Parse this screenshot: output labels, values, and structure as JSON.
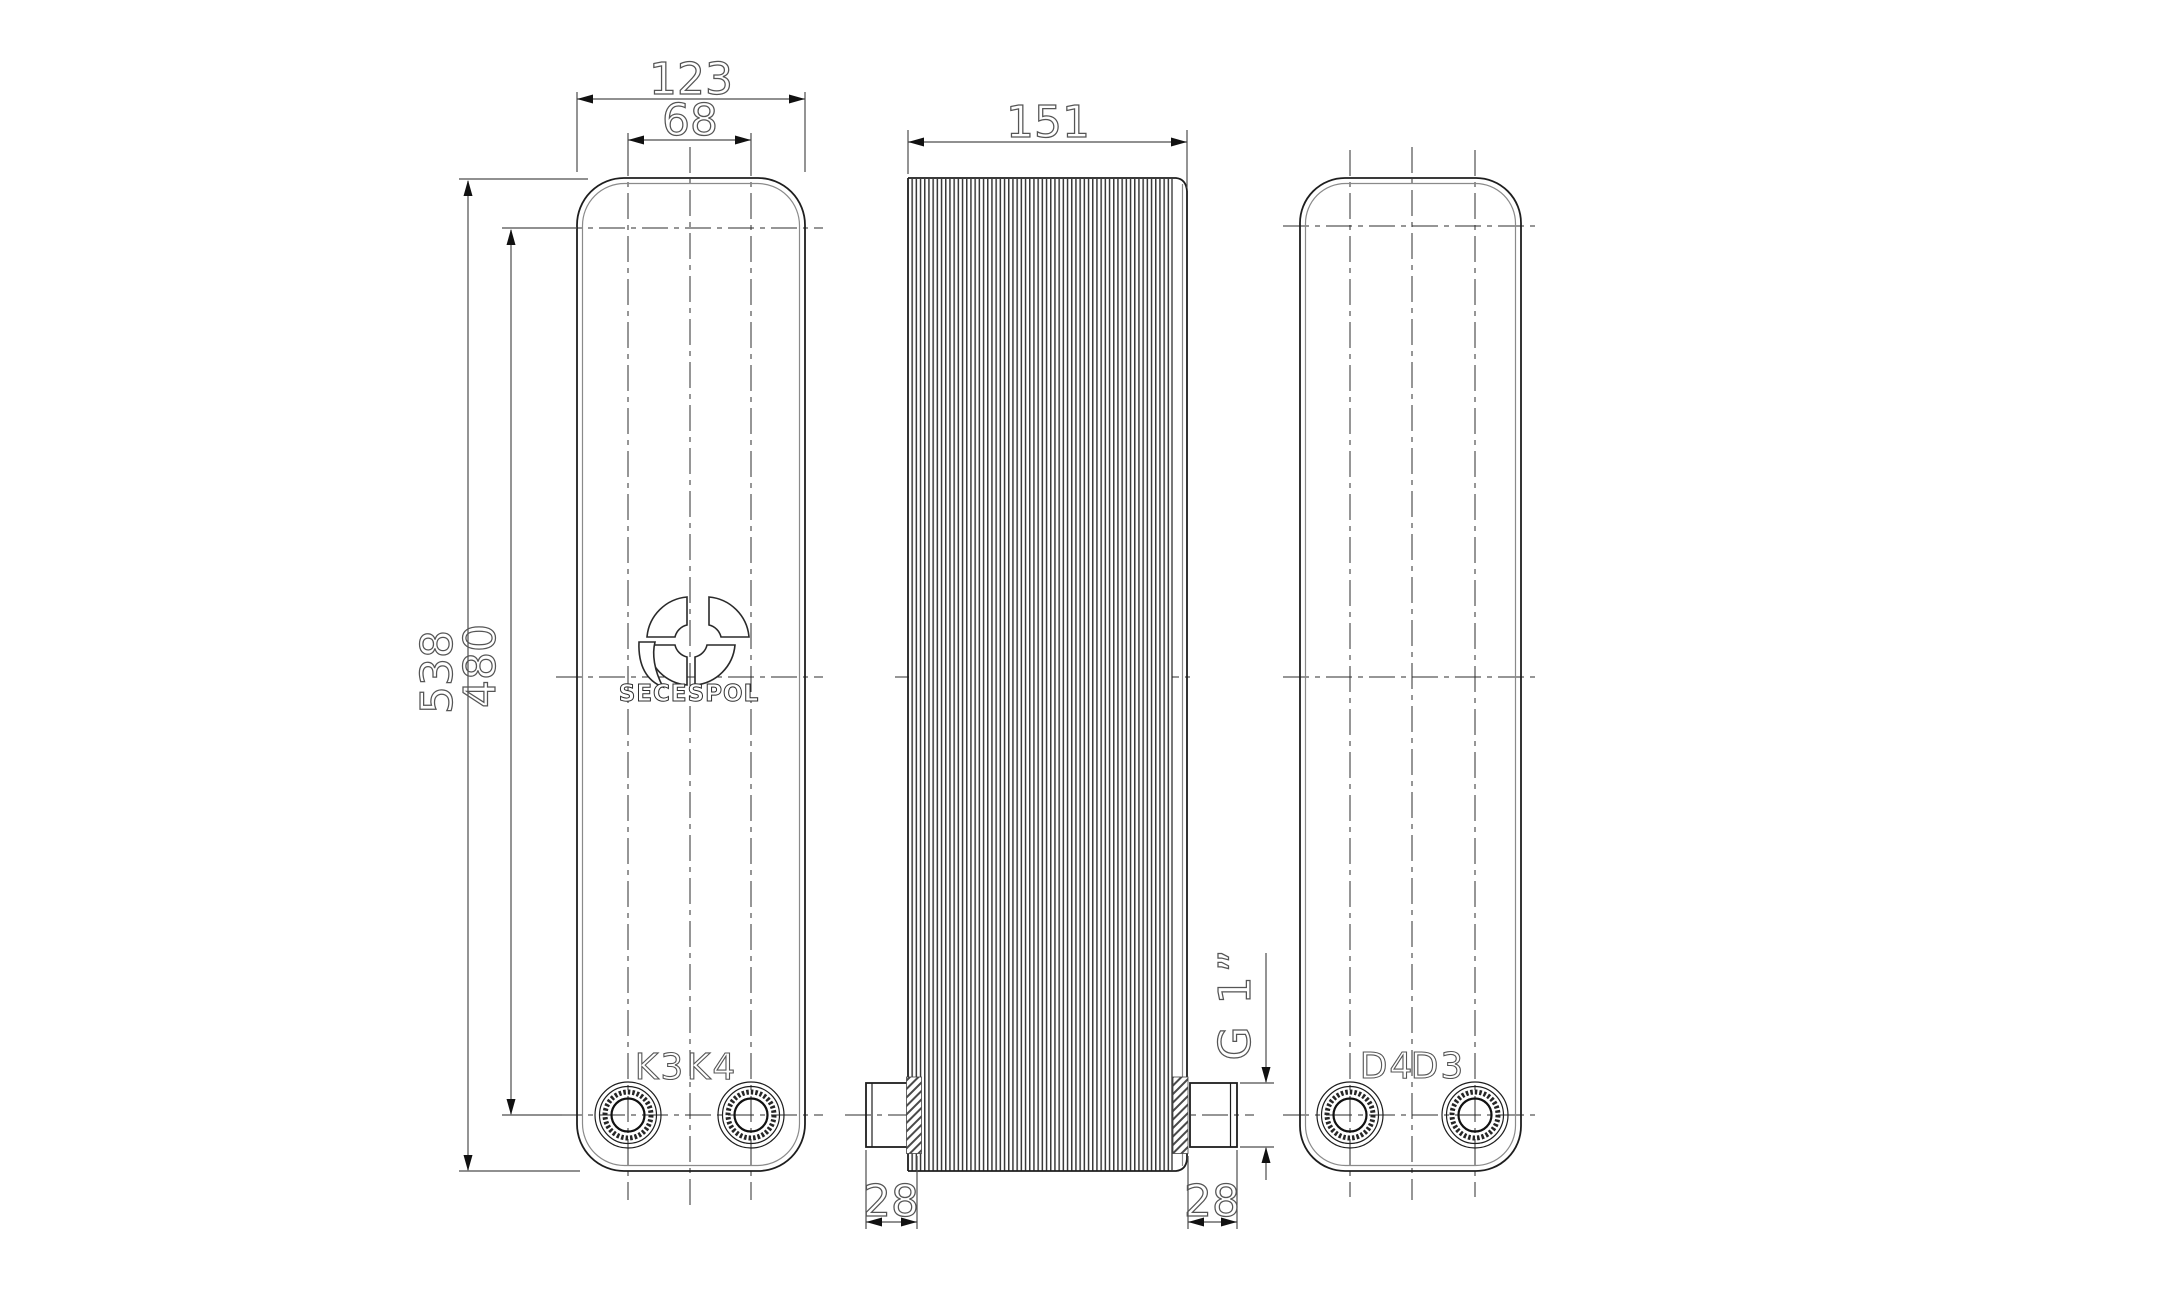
{
  "brand": {
    "logo_text": "SECESPOL"
  },
  "front_view": {
    "port_labels": [
      "K3",
      "K4"
    ],
    "dim_width": "123",
    "dim_port_spacing": "68",
    "dim_height": "538",
    "dim_port_height": "480"
  },
  "side_view": {
    "dim_depth": "151",
    "dim_stub_left": "28",
    "dim_stub_right": "28",
    "dim_thread": "G 1”"
  },
  "back_view": {
    "port_labels": [
      "D4",
      "D3"
    ]
  }
}
